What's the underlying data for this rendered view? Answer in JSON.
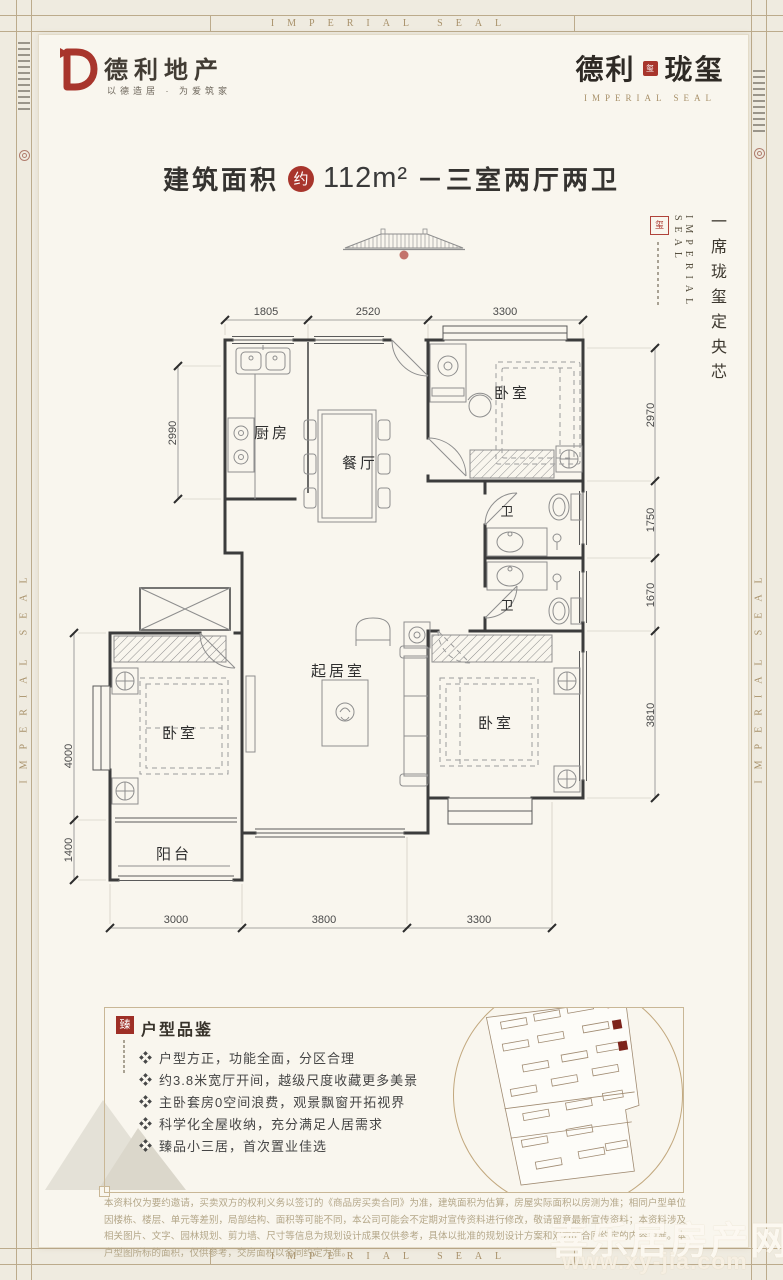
{
  "frame": {
    "band_text": "IMPERIAL SEAL"
  },
  "brand": {
    "logo_name": "德利地产",
    "logo_tagline": "以德造居 · 为爱筑家",
    "title_cn_left": "德利",
    "title_seal": "玺",
    "title_cn_right": "珑玺",
    "title_en": "IMPERIAL SEAL"
  },
  "headline": {
    "prefix": "建筑面积",
    "badge": "约",
    "area": "112m²",
    "suffix": "－三室两厅两卫"
  },
  "side_column": {
    "en_word1": "IMPERIAL",
    "en_word2": "SEAL",
    "slogan": "一席珑玺定央芯"
  },
  "plan": {
    "rooms": {
      "kitchen": "厨房",
      "dining": "餐厅",
      "bedroom_top": "卧室",
      "bath_1": "卫",
      "bath_2": "卫",
      "living": "起居室",
      "bedroom_left": "卧室",
      "bedroom_right": "卧室",
      "balcony": "阳台"
    },
    "dims": {
      "top": [
        "1805",
        "2520",
        "3300"
      ],
      "bottom": [
        "3000",
        "3800",
        "3300"
      ],
      "left": [
        "2990",
        "4000",
        "1400"
      ],
      "right": [
        "2970",
        "1750",
        "1670",
        "3810"
      ]
    }
  },
  "features": {
    "seal_char": "臻",
    "heading": "户型品鉴",
    "items": [
      "户型方正，功能全面，分区合理",
      "约3.8米宽厅开间，越级尺度收藏更多美景",
      "主卧套房0空间浪费，观景飘窗开拓视界",
      "科学化全屋收纳，充分满足人居需求",
      "臻品小三居，首次置业佳选"
    ]
  },
  "disclaimer": "本资料仅为要约邀请，买卖双方的权利义务以签订的《商品房买卖合同》为准，建筑面积为估算，房屋实际面积以房测为准；相同户型单位因楼栋、楼层、单元等差别，局部结构、面积等可能不同，本公司可能会不定期对宣传资料进行修改，敬请留意最新宣传资料；本资料涉及相关图片、文字、园林规划、剪力墙、尺寸等信息为规划设计成果仅供参考，具体以批准的规划设计方案和双方的合同约定的内容为准。本户型图所标的面积，仅供参考，交房面积以合同约定为准。",
  "watermark": {
    "line1": "喜乐居房产网",
    "line2": "www.xy-jia.com"
  },
  "colors": {
    "brand_red": "#a8352c",
    "gold": "#a8916a",
    "ink": "#37322a",
    "tan": "#b4a789"
  }
}
